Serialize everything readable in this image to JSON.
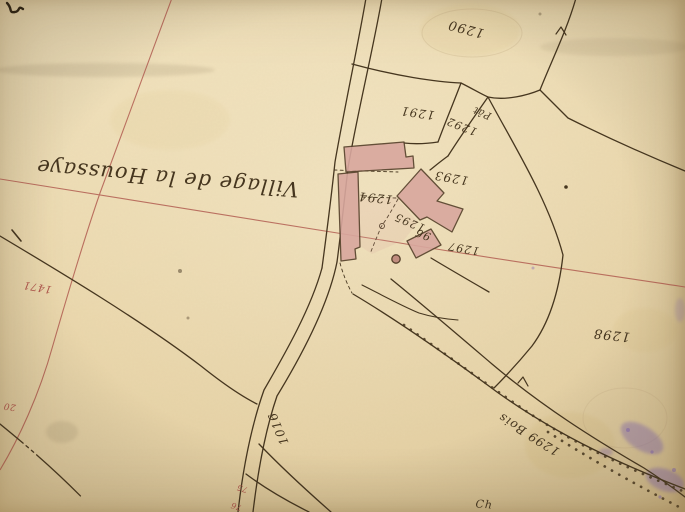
{
  "map": {
    "village_label": "Village de la Houssaye",
    "parcel_labels": {
      "p1290": "1290",
      "p1291": "1291",
      "p1292": "1292",
      "p1292_type": "Pât",
      "p1293": "1293",
      "p1294": "1294",
      "p1295": "1295",
      "p1296": "96",
      "p1297": "1297",
      "p1298": "1298",
      "p1299_bois": "1299 Bois",
      "road_number": "1016",
      "partial_label": "Ch"
    },
    "red_annotations": {
      "r1471": "1471",
      "r20": "20",
      "r75": "75",
      "r76": "76"
    },
    "colors": {
      "paper": "#ebd8ad",
      "ink": "#46361f",
      "red_line": "#ae554b",
      "building_fill": "#d8a79e",
      "purple_stain": "#7f63b5"
    }
  }
}
